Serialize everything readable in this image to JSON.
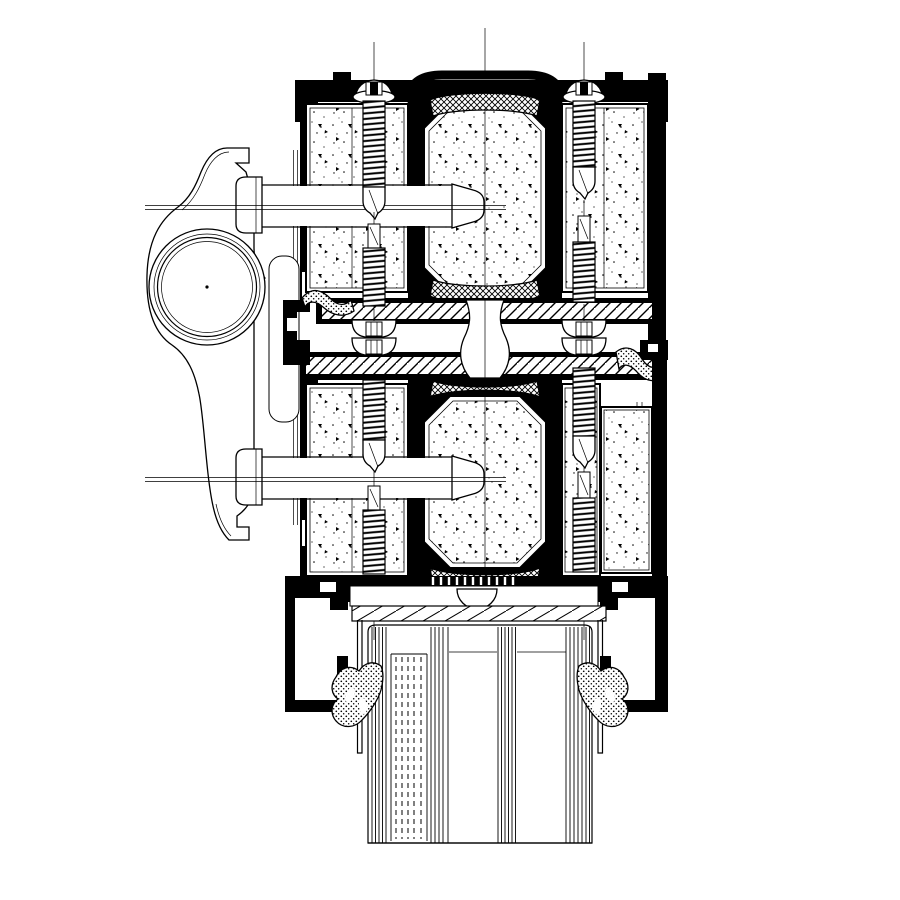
{
  "meta": {
    "type": "technical-section-drawing",
    "subject": "Aluminum window / curtain-wall mullion cross-section detail",
    "canvas": {
      "width": 900,
      "height": 900
    },
    "visible_text": []
  },
  "colors": {
    "line": "#000000",
    "background": "#ffffff"
  },
  "components": {
    "bracket": "Operating handle / hinge bracket with circular boss",
    "bracket-boss": "Concentric circular hinge boss",
    "mount-slot": "Rounded mounting slot between bracket and frame",
    "top-frame-profile": "Upper aluminium frame cap profile with fixing screws",
    "insulation-block": "Stippled thermal insulation infill block",
    "thermal-core": "Octagonal insulating core with cross-hatched gaskets",
    "gasket-crosshatch": "Cross-hatched EPDM gasket band",
    "fixing-screw": "Self-tapping fixing screw with washer head",
    "connection-bolt": "Horizontal fixing bolt with mushroom head",
    "mid-connection": "Hatched aluminium coupling bands with stacked washers",
    "gasket-seal": "Stippled rubber seal",
    "bottom-frame-profile": "Lower glazing channel frame profile",
    "setting-block": "Hatched glazing setting block",
    "glazing-unit": "Triple insulated glazing unit with laminated pane",
    "glazing-gasket": "Wing-shaped glazing rubber gasket"
  }
}
